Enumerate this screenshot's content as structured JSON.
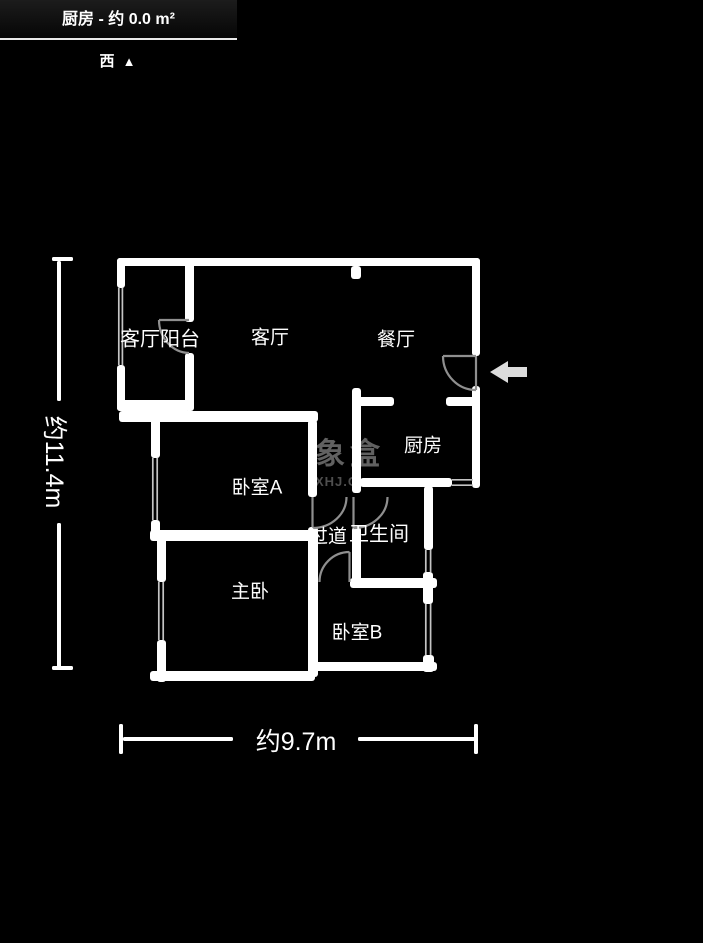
{
  "header": {
    "title": "厨房 - 约 0.0 m²"
  },
  "compass": {
    "direction": "西",
    "arrow": "▲"
  },
  "rooms": [
    {
      "id": "living-balcony",
      "label": "客厅阳台"
    },
    {
      "id": "living-room",
      "label": "客厅"
    },
    {
      "id": "dining-room",
      "label": "餐厅"
    },
    {
      "id": "kitchen",
      "label": "厨房"
    },
    {
      "id": "bedroom-a",
      "label": "卧室A"
    },
    {
      "id": "bathroom",
      "label": "卫生间"
    },
    {
      "id": "hallway",
      "label": "过道"
    },
    {
      "id": "master-bedroom",
      "label": "主卧"
    },
    {
      "id": "bedroom-b",
      "label": "卧室B"
    }
  ],
  "dimensions": {
    "height": "约11.4m",
    "width": "约9.7m"
  },
  "watermark": {
    "name": "象盒",
    "domain": "XHJ.C"
  },
  "colors": {
    "background": "#000000",
    "wall": "#ffffff",
    "door_arc": "#8f8f8f",
    "window_line": "#c4c4c4",
    "dimension_line": "#ffffff",
    "entrance_arrow": "#dcdcdc",
    "watermark_text": "#616161"
  }
}
